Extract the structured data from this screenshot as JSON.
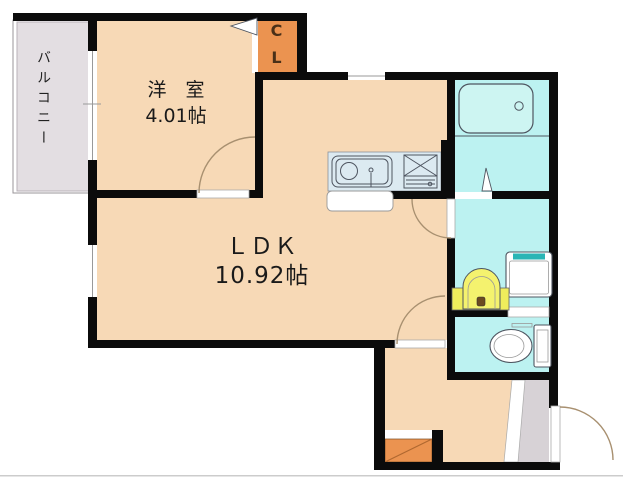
{
  "rooms": {
    "yoshitsu": {
      "name": "洋　室",
      "size": "4.01帖"
    },
    "ldk": {
      "name": "ＬＤＫ",
      "size": "10.92帖"
    },
    "closet": {
      "line1": "C",
      "line2": "L"
    },
    "balcony": {
      "name": "バルコニー"
    }
  },
  "icons": [
    "bathtub-icon",
    "kitchen-sink-icon",
    "gas-stove-icon",
    "washbasin-icon",
    "washing-machine-icon",
    "toilet-icon",
    "shoe-cabinet-icon",
    "door-swing-arc",
    "folding-door-triangle",
    "window-symbol"
  ],
  "colors": {
    "wall": "#0b0b0b",
    "room_peach": "#f7d9b6",
    "closet_orange": "#eb9350",
    "water_cyan": "#bcf2f1",
    "tub_cyan": "#cdf5f2",
    "kitchen_blue": "#dceaf1",
    "balcony_gray": "#e3dee2",
    "entrance_gray": "#d7d2d6",
    "vanity_yellow": "#efed5c",
    "basin_yellow": "#f4f26e",
    "washer_teal": "#2ab5b5",
    "line": "#4e5560",
    "arc": "#a89070",
    "window_line": "#999999",
    "shoe_diag": "#b06830",
    "text": "#1a1a1a"
  }
}
